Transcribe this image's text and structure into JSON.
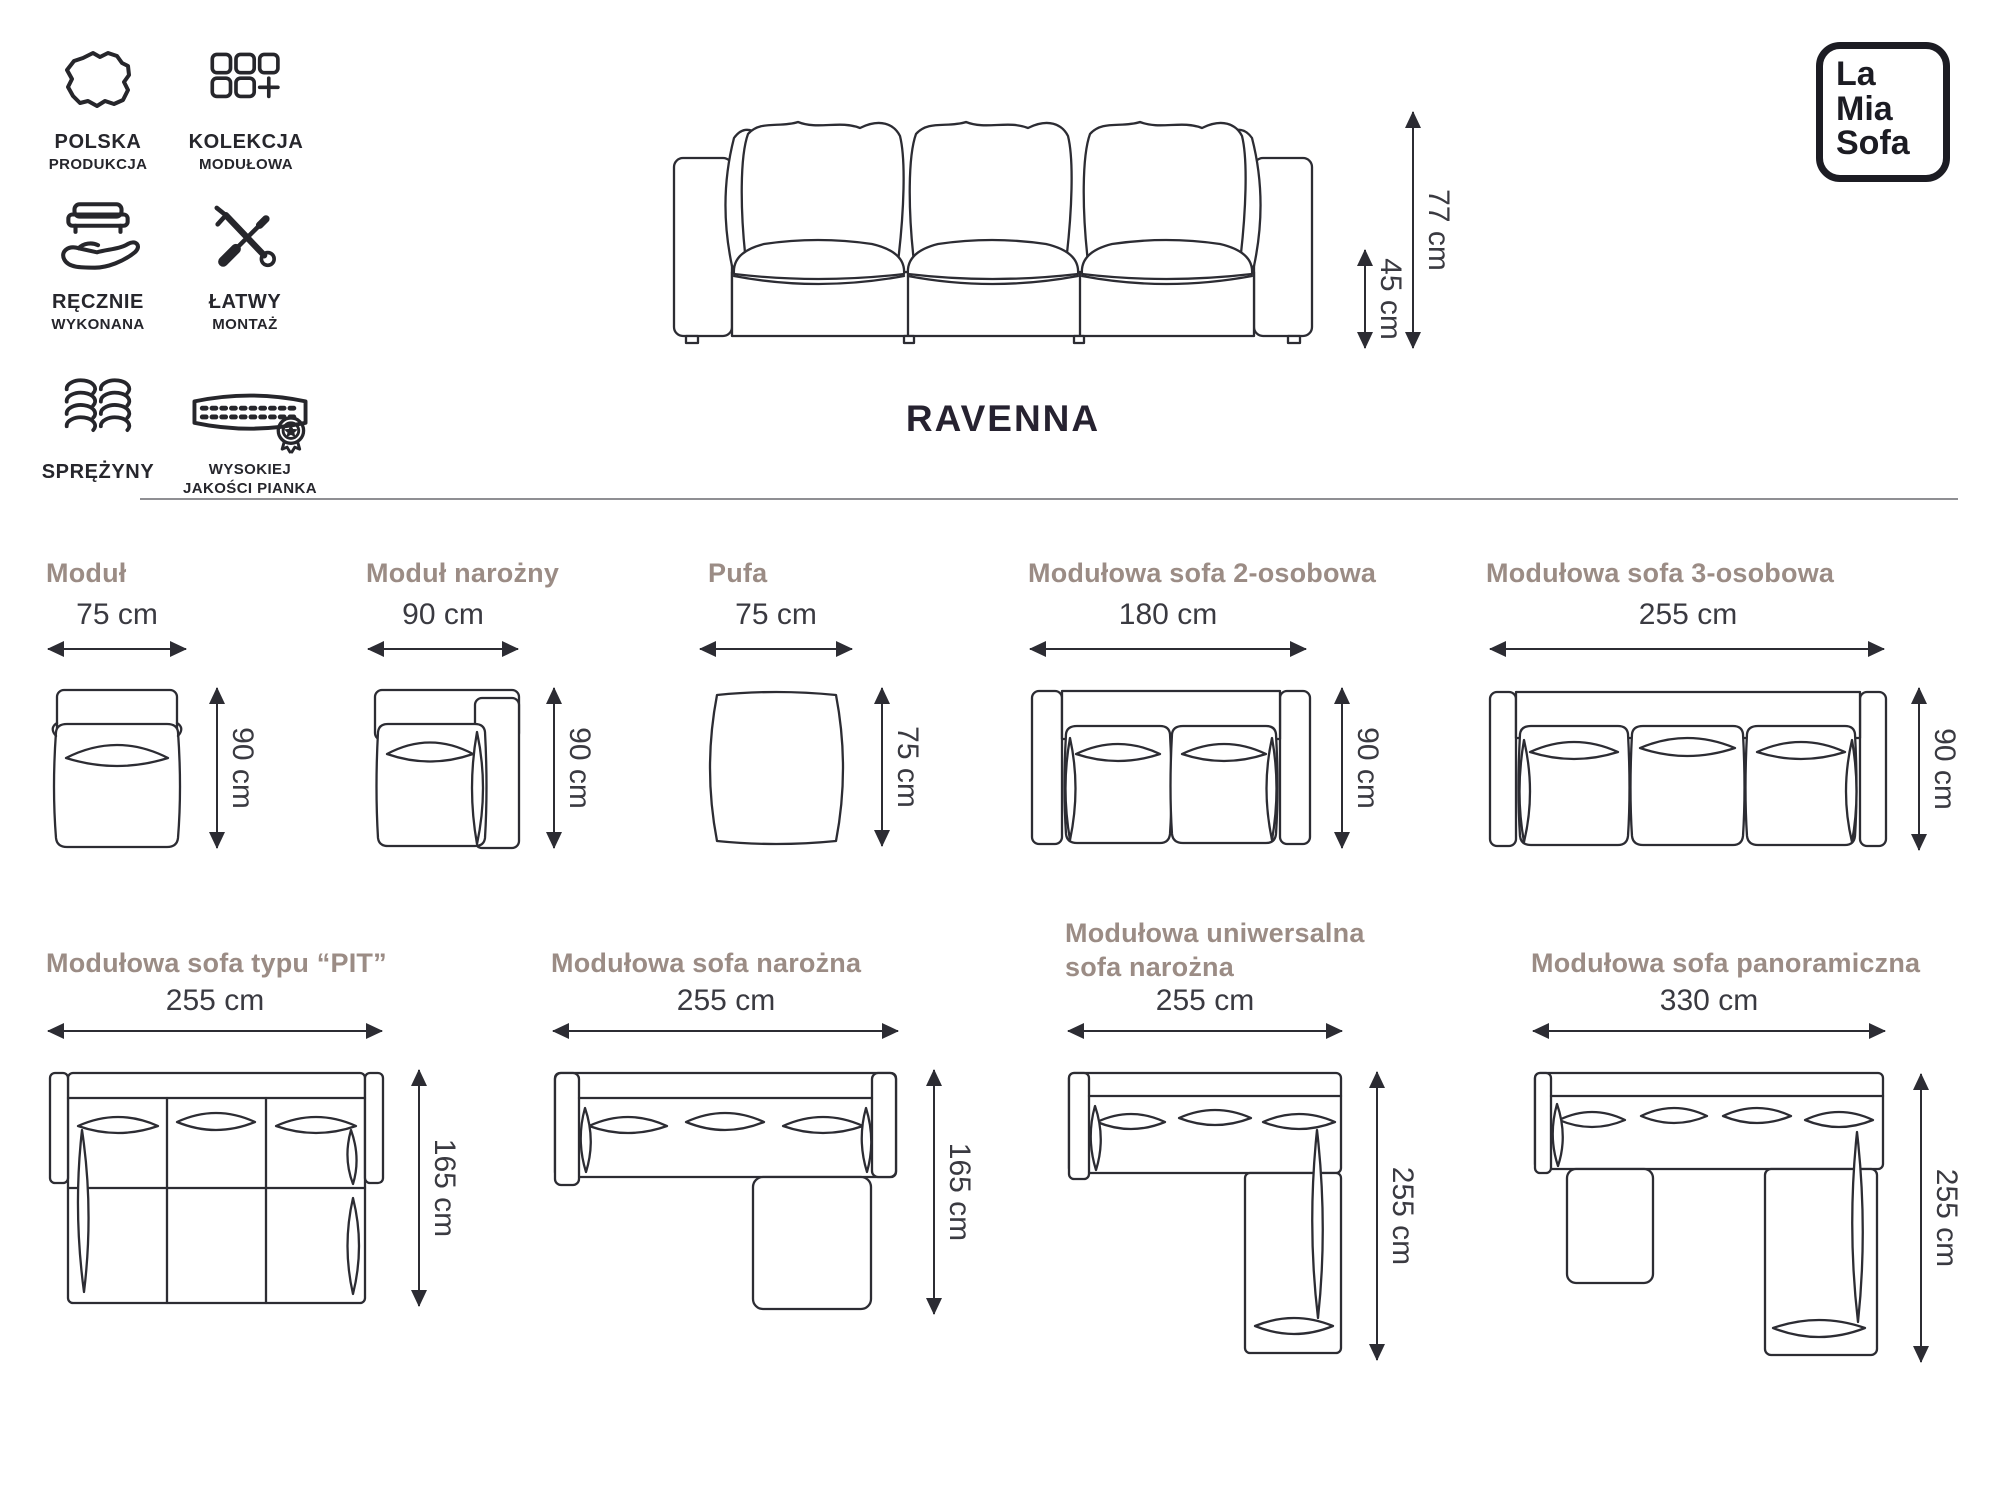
{
  "header": {
    "features": [
      {
        "icon": "poland-map-icon",
        "line1": "POLSKA",
        "line2": "PRODUKCJA"
      },
      {
        "icon": "modules-grid-icon",
        "line1": "KOLEKCJA",
        "line2": "MODUŁOWA"
      },
      {
        "icon": "handmade-icon",
        "line1": "RĘCZNIE",
        "line2": "WYKONANA"
      },
      {
        "icon": "tools-icon",
        "line1": "ŁATWY",
        "line2": "MONTAŻ"
      },
      {
        "icon": "springs-icon",
        "line1": "SPRĘŻYNY",
        "line2": ""
      },
      {
        "icon": "foam-icon",
        "line1": "WYSOKIEJ",
        "line2": "JAKOŚCI PIANKA"
      }
    ],
    "product_name": "RAVENNA",
    "total_height": "77 cm",
    "seat_height": "45 cm",
    "logo": {
      "line1": "La",
      "line2": "Mia",
      "line3": "Sofa"
    }
  },
  "modules": [
    {
      "name": "Moduł",
      "width": "75 cm",
      "height": "90 cm"
    },
    {
      "name": "Moduł narożny",
      "width": "90 cm",
      "height": "90 cm"
    },
    {
      "name": "Pufa",
      "width": "75 cm",
      "height": "75 cm"
    },
    {
      "name": "Modułowa sofa 2-osobowa",
      "width": "180 cm",
      "height": "90 cm"
    },
    {
      "name": "Modułowa sofa 3-osobowa",
      "width": "255 cm",
      "height": "90 cm"
    },
    {
      "name": "Modułowa sofa typu “PIT”",
      "width": "255 cm",
      "height": "165 cm"
    },
    {
      "name": "Modułowa sofa narożna",
      "width": "255 cm",
      "height": "165 cm"
    },
    {
      "name": "Modułowa uniwersalna sofa narożna",
      "width": "255 cm",
      "height": "255 cm"
    },
    {
      "name": "Modułowa sofa panoramiczna",
      "width": "330 cm",
      "height": "255 cm"
    }
  ],
  "colors": {
    "line": "#2c2c33",
    "title_accent": "#9b8c85",
    "dim_text": "#3a3a41"
  }
}
